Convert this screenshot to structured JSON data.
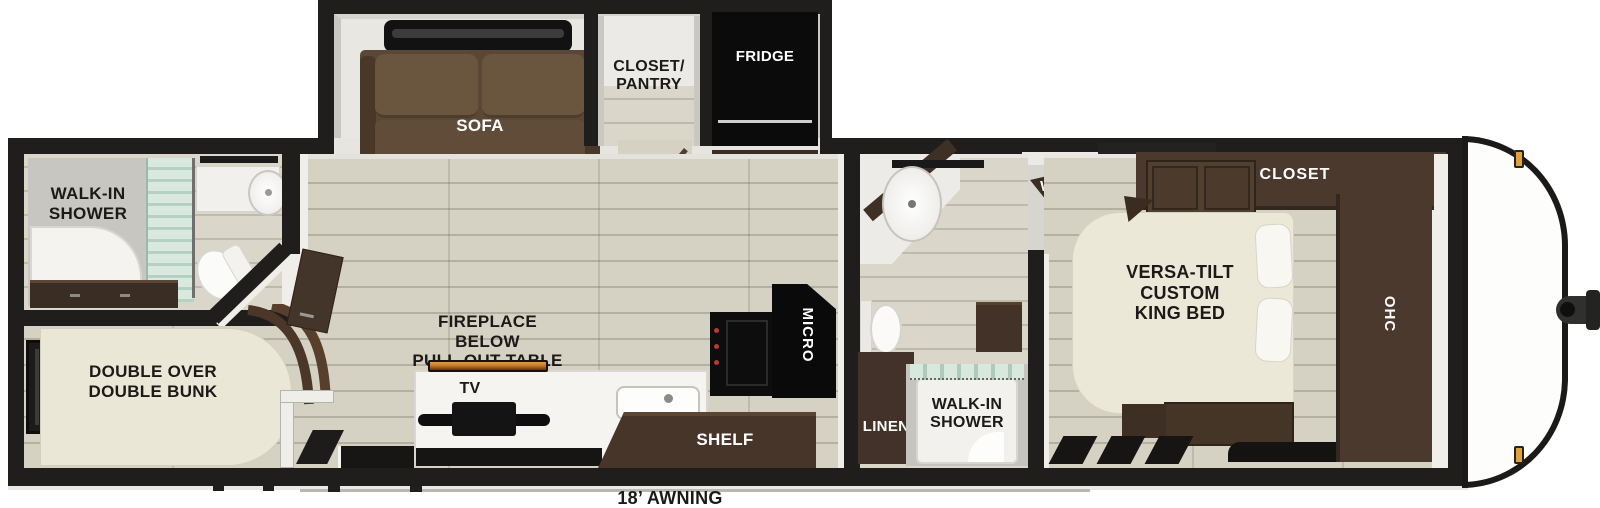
{
  "labels": {
    "awning": "18’ AWNING",
    "rear_shower": "WALK-IN\nSHOWER",
    "bunk": "DOUBLE OVER\nDOUBLE BUNK",
    "sofa": "SOFA",
    "closet_pantry": "CLOSET/\nPANTRY",
    "fridge": "FRIDGE",
    "fireplace": "FIREPLACE\nBELOW\nPULL-OUT TABLE",
    "tv": "TV",
    "shelf": "SHELF",
    "micro": "MICRO",
    "linen": "LINEN",
    "mid_shower": "WALK-IN\nSHOWER",
    "washer": "WASHER\nDRYER\nPREP",
    "king_bed": "VERSA-TILT\nCUSTOM\nKING BED",
    "closet": "CLOSET",
    "ohc": "OHC"
  },
  "colors": {
    "wall": "#201e1c",
    "floor_plank": "#d5d1c3",
    "plank_line": "#bdb9ab",
    "cabinet_wood": "#4a392c",
    "cabinet_wood_dark": "#3a2d23",
    "sofa_brown": "#5f4b39",
    "mattress_cream": "#ece8d8",
    "appliance_black": "#0d0d0d",
    "shower_glass": "#cfe3da",
    "fireplace_flame": "#c87b2c",
    "marker_light_amber": "#dfa13d",
    "label_dark": "#1b1a18",
    "label_light": "#ffffff"
  }
}
